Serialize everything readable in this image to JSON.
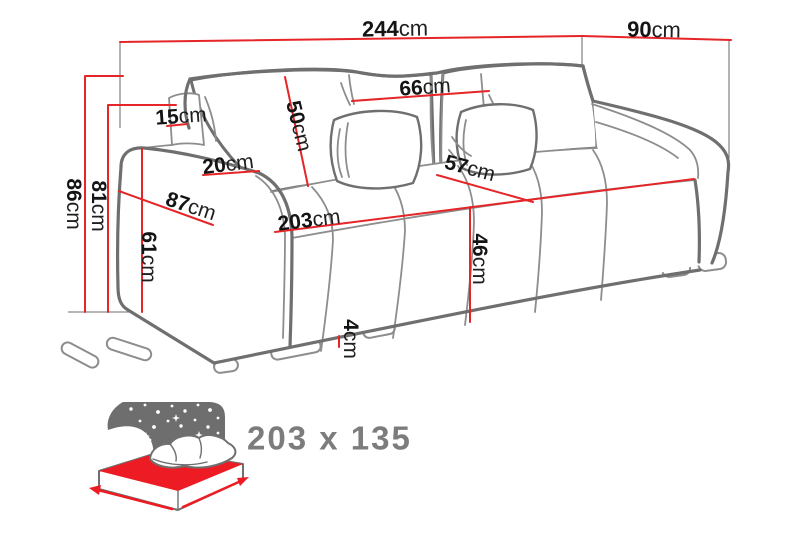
{
  "title": "Sofa dimensions diagram",
  "colors": {
    "dimension_line": "#e52528",
    "outline": "#6f6f6f",
    "label_text": "#141414",
    "icon_gray": "#6e6e6e",
    "icon_red": "#ed1c24",
    "sleeping_text": "#7c7c7c"
  },
  "dims": {
    "total_width": {
      "v": "244",
      "u": "cm"
    },
    "total_depth": {
      "v": "90",
      "u": "cm"
    },
    "total_height": {
      "v": "86",
      "u": "cm"
    },
    "back_height": {
      "v": "81",
      "u": "cm"
    },
    "armrest_height": {
      "v": "61",
      "u": "cm"
    },
    "backrest_top_width": {
      "v": "15",
      "u": "cm"
    },
    "armrest_width": {
      "v": "20",
      "u": "cm"
    },
    "depth_with_armrest": {
      "v": "87",
      "u": "cm"
    },
    "back_cushion_height": {
      "v": "50",
      "u": "cm"
    },
    "back_cushion_width": {
      "v": "66",
      "u": "cm"
    },
    "seat_depth": {
      "v": "57",
      "u": "cm"
    },
    "seat_width": {
      "v": "203",
      "u": "cm"
    },
    "seat_height": {
      "v": "46",
      "u": "cm"
    },
    "leg_height": {
      "v": "4",
      "u": "cm"
    }
  },
  "sleeping_area": {
    "label": "203 x 135"
  }
}
